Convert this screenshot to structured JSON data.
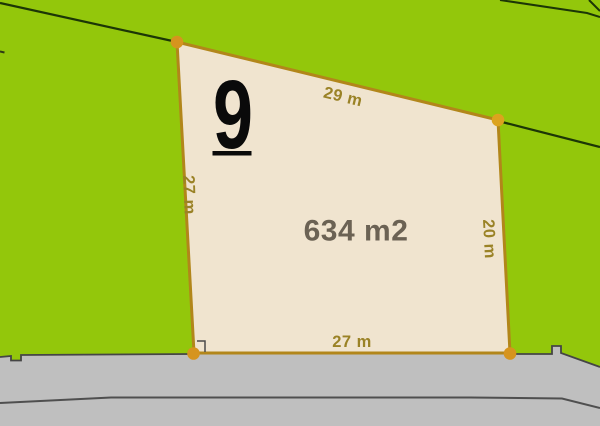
{
  "map": {
    "plot_number": "9",
    "area": "634 m2",
    "dimensions": {
      "top": "29 m",
      "left": "27 m",
      "right": "20 m",
      "bottom": "27 m"
    },
    "colors": {
      "background_green": "#93C70B",
      "plot_fill": "#F0E4CF",
      "plot_border": "#B2861A",
      "vertex_marker": "#D6941E",
      "dimension_text": "#9A8226",
      "area_text": "#6B6254",
      "plot_number_text": "#0A0A0A",
      "road_fill": "#BFBFBF",
      "road_edge_line": "#454545",
      "boundary_line": "#1C3606"
    }
  }
}
